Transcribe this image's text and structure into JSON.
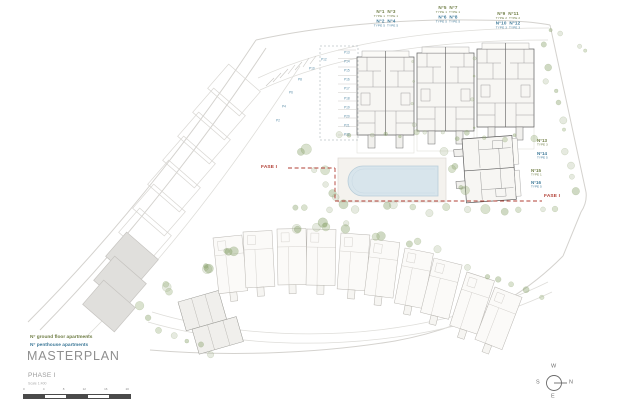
{
  "header_labels": {
    "groups": [
      {
        "l1": "N°1  N°3",
        "l2": "TYPE 1  TYPE 1",
        "l3": "N°2  N°4",
        "l4": "TYPE 5  TYPE 5"
      },
      {
        "l1": "N°5  N°7",
        "l2": "TYPE 1  TYPE 1",
        "l3": "N°6  N°8",
        "l4": "TYPE 5  TYPE 5"
      },
      {
        "l1": "N°9  N°11",
        "l2": "TYPE 2  TYPE 2",
        "l3": "N°10  N°12",
        "l4": "TYPE 3  TYPE 3"
      }
    ]
  },
  "side_labels": [
    {
      "num": "N°13",
      "type": "TYPE 3"
    },
    {
      "num": "N°14",
      "type": "TYPE 5"
    },
    {
      "num": "N°15",
      "type": "TYPE 1"
    },
    {
      "num": "N°16",
      "type": "TYPE 5"
    }
  ],
  "phase_boundary": {
    "label_left": "FASE I",
    "label_right": "FASE I"
  },
  "parking": {
    "column": [
      "P13",
      "P14",
      "P15",
      "P16",
      "P17",
      "P18",
      "P19",
      "P20",
      "P21",
      "P22"
    ],
    "curve": [
      "P2",
      "P4",
      "P6",
      "P8",
      "P10",
      "P12"
    ]
  },
  "legend": {
    "ground": "N° ground floor apartments",
    "penthouse": "N° penthouse apartments"
  },
  "title_block": {
    "title": "MASTERPLAN",
    "phase": "PHASE I",
    "scale": "Scale 1:400",
    "scale_ticks": [
      "0",
      "4",
      "8",
      "12",
      "16",
      "20"
    ]
  },
  "compass": {
    "n": "N",
    "s": "S",
    "e": "E",
    "w": "W"
  },
  "colors": {
    "ground": "#6f7d45",
    "penthouse": "#3f7a99",
    "phase": "#b13f35",
    "pool": "#d8e5ec"
  }
}
